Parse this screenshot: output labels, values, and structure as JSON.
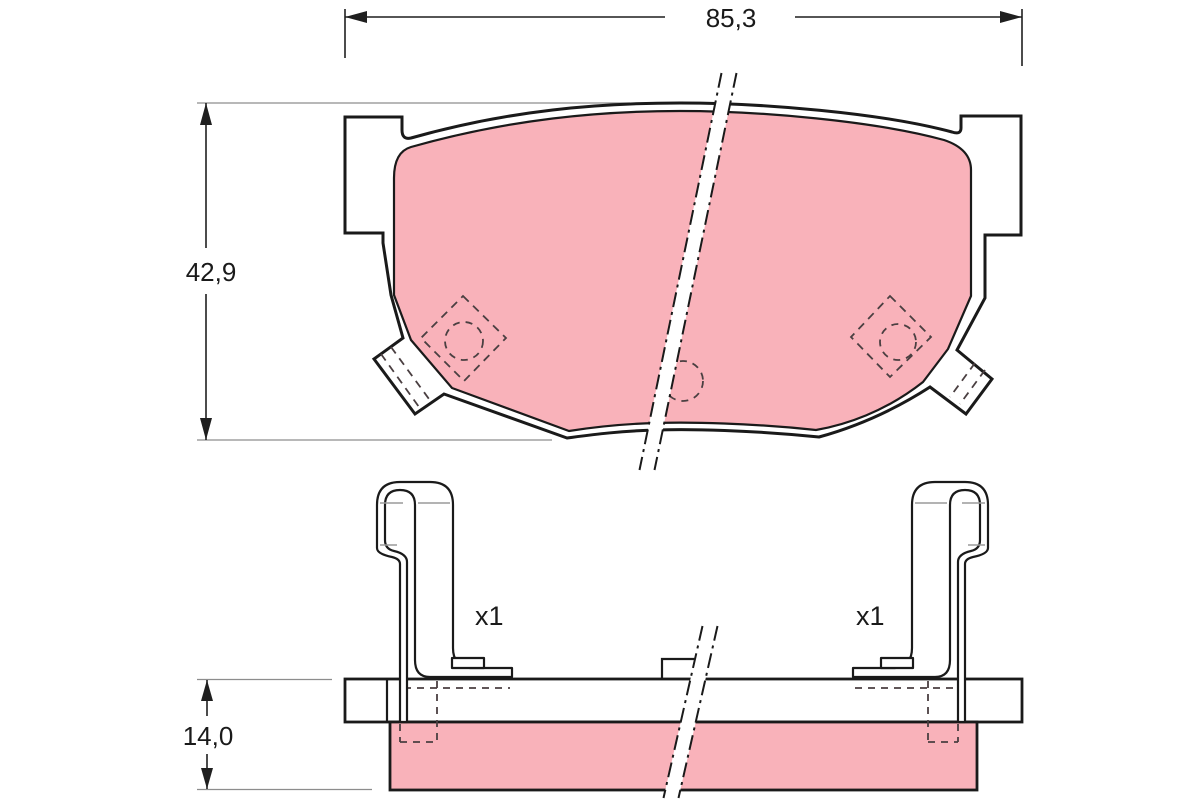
{
  "drawing": {
    "dimensions": {
      "width": "85,3",
      "height": "42,9",
      "thickness": "14,0"
    },
    "quantities": {
      "left_spring": "x1",
      "right_spring": "x1"
    },
    "colors": {
      "friction": "#f9b2ba",
      "outline": "#1a1a1a",
      "dimension": "#1f1f1f",
      "extension": "#8d8d8d",
      "hidden": "#4a3f41",
      "detail": "#9a9a9a",
      "background": "#ffffff"
    }
  }
}
